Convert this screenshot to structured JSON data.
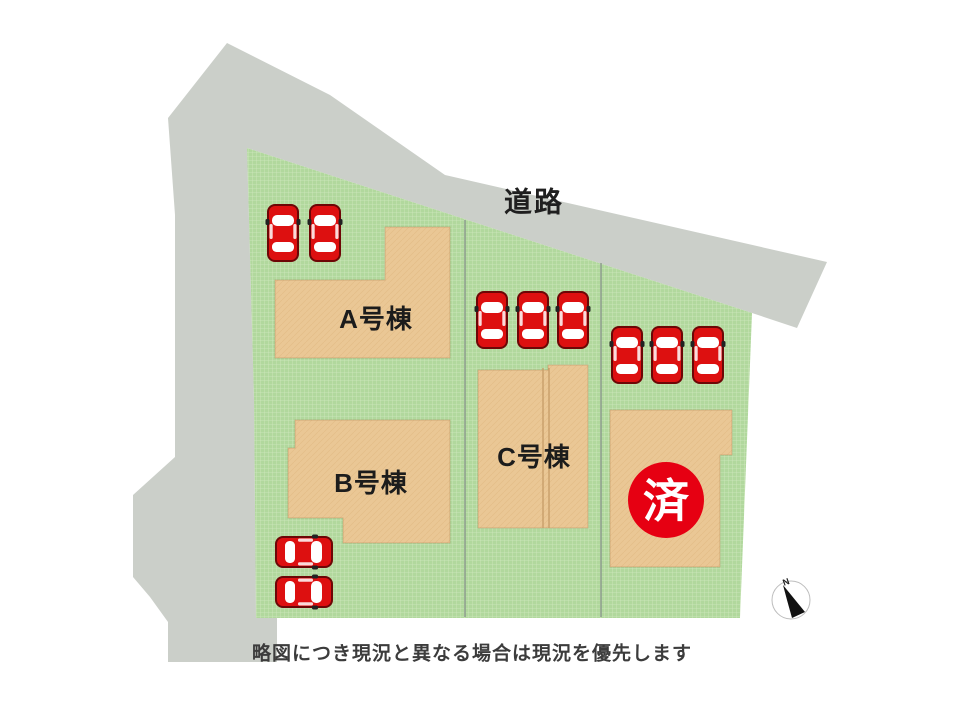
{
  "plan": {
    "road_label": "道路",
    "buildings": [
      {
        "id": "A",
        "label": "A号棟",
        "status": "available"
      },
      {
        "id": "B",
        "label": "B号棟",
        "status": "available"
      },
      {
        "id": "C",
        "label": "C号棟",
        "status": "available"
      },
      {
        "id": "D",
        "label": "",
        "status": "sold"
      }
    ],
    "sold_badge": {
      "label": "済"
    },
    "note": "略図につき現況と異なる場合は現況を優先します",
    "compass": {
      "label": "N"
    },
    "cars": [
      {
        "x": 283,
        "y": 233,
        "rot": 0
      },
      {
        "x": 325,
        "y": 233,
        "rot": 0
      },
      {
        "x": 492,
        "y": 320,
        "rot": 0
      },
      {
        "x": 533,
        "y": 320,
        "rot": 0
      },
      {
        "x": 573,
        "y": 320,
        "rot": 0
      },
      {
        "x": 627,
        "y": 355,
        "rot": 0
      },
      {
        "x": 667,
        "y": 355,
        "rot": 0
      },
      {
        "x": 708,
        "y": 355,
        "rot": 0
      },
      {
        "x": 304,
        "y": 552,
        "rot": 90
      },
      {
        "x": 304,
        "y": 592,
        "rot": 90
      }
    ],
    "colors": {
      "road": "#cbcfc9",
      "grass_base": "#b1d89d",
      "grass_line": "#d0e9bf",
      "building_base": "#eac795",
      "building_grain": "#dbae77",
      "lot_line": "#8b9c8b",
      "car_red": "#dd1010",
      "car_outline": "#6d0606",
      "badge_red": "#e60012"
    }
  }
}
